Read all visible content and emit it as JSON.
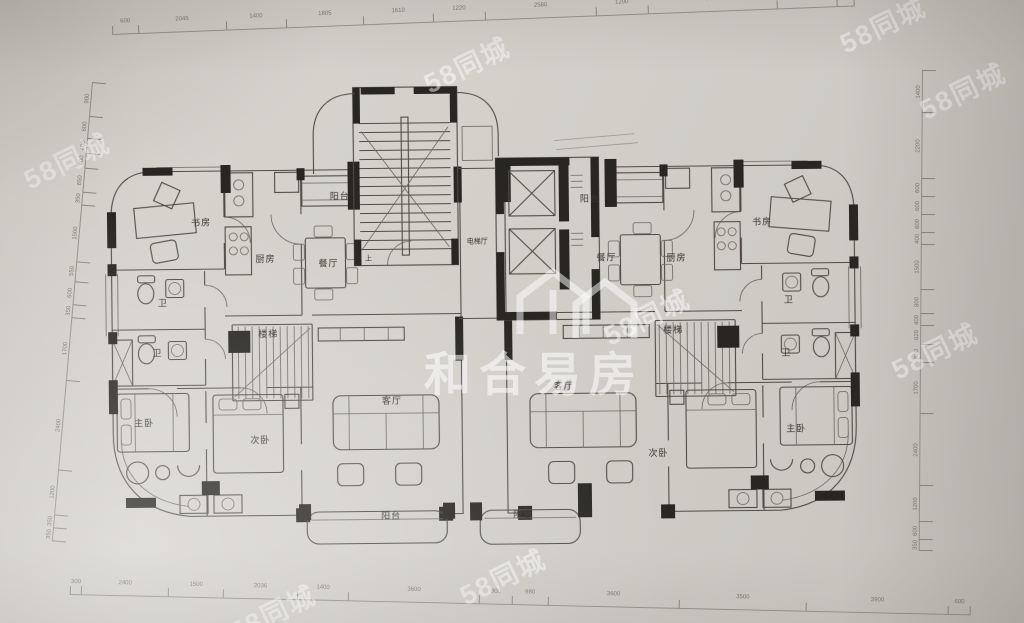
{
  "watermarks": {
    "site": "58同城",
    "brand": "和合易房"
  },
  "plan": {
    "labels": {
      "study": "书房",
      "kitchen": "厨房",
      "dining": "餐厅",
      "bath": "卫",
      "stairs": "楼梯",
      "living": "客厅",
      "master": "主卧",
      "second": "次卧",
      "balcony": "阳台",
      "elevator_hall": "电梯厅",
      "up": "上"
    }
  },
  "dimensions": {
    "top": [
      "600",
      "2045",
      "1400",
      "1805",
      "1610",
      "1220",
      "2580",
      "1200",
      "3000",
      "1400",
      "400"
    ],
    "bottom": [
      "300",
      "2400",
      "1500",
      "2036",
      "1400",
      "3600",
      "900",
      "980",
      "3600",
      "3500",
      "3900",
      "600"
    ],
    "left": [
      "900",
      "600",
      "400",
      "400",
      "650",
      "350",
      "1500",
      "550",
      "600",
      "350",
      "1700",
      "2400",
      "1200",
      "350",
      "350"
    ],
    "right": [
      "1400",
      "2200",
      "600",
      "600",
      "600",
      "400",
      "1500",
      "800",
      "400",
      "620",
      "600",
      "1700",
      "2400",
      "1200",
      "600",
      "350"
    ]
  }
}
